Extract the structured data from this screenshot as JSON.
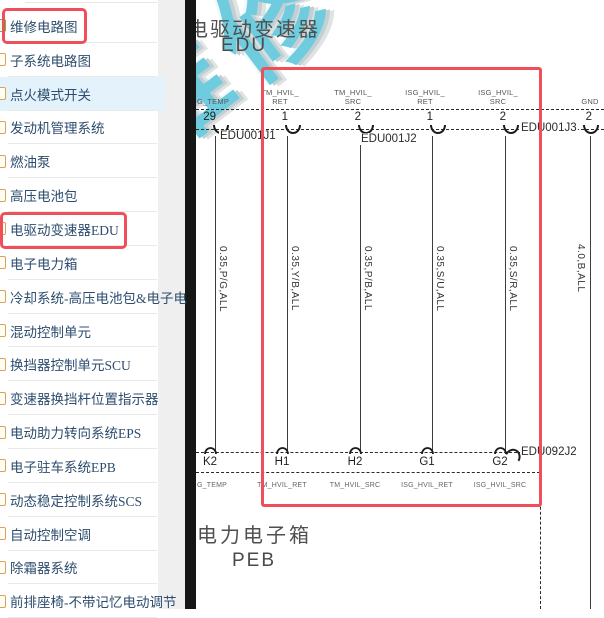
{
  "sidebar": {
    "items": [
      {
        "label": "维修电路图",
        "boxed": true,
        "active": false
      },
      {
        "label": "子系统电路图",
        "boxed": false,
        "active": false
      },
      {
        "label": "点火模式开关",
        "boxed": false,
        "active": true
      },
      {
        "label": "发动机管理系统",
        "boxed": false,
        "active": false
      },
      {
        "label": "燃油泵",
        "boxed": false,
        "active": false
      },
      {
        "label": "高压电池包",
        "boxed": false,
        "active": false
      },
      {
        "label": "电驱动变速器EDU",
        "boxed": true,
        "active": false
      },
      {
        "label": "电子电力箱",
        "boxed": false,
        "active": false
      },
      {
        "label": "冷却系统-高压电池包&电子电",
        "boxed": false,
        "active": false
      },
      {
        "label": "混动控制单元",
        "boxed": false,
        "active": false
      },
      {
        "label": "换挡器控制单元SCU",
        "boxed": false,
        "active": false
      },
      {
        "label": "变速器换挡杆位置指示器",
        "boxed": false,
        "active": false
      },
      {
        "label": "电动助力转向系统EPS",
        "boxed": false,
        "active": false
      },
      {
        "label": "电子驻车系统EPB",
        "boxed": false,
        "active": false
      },
      {
        "label": "动态稳定控制系统SCS",
        "boxed": false,
        "active": false
      },
      {
        "label": "自动控制空调",
        "boxed": false,
        "active": false
      },
      {
        "label": "除霜器系统",
        "boxed": false,
        "active": false
      },
      {
        "label": "前排座椅-不带记忆电动调节",
        "boxed": false,
        "active": false
      }
    ]
  },
  "diagram": {
    "watermark": "维修",
    "top_component": {
      "name": "电驱动变速器",
      "abbr": "EDU"
    },
    "bottom_component": {
      "name": "电力电子箱",
      "abbr": "PEB"
    },
    "top_connectors": {
      "j1": "EDU001J1",
      "j2": "EDU001J2",
      "j3": "EDU001J3"
    },
    "bottom_connector": "EDU092J2",
    "wires": [
      {
        "top_signal_l1": "G_TEMP",
        "top_signal_l2": "",
        "pin": "29",
        "label": "0.35,P/G,ALL",
        "bottom_pin": "K2",
        "bottom_signal": "G_TEMP"
      },
      {
        "top_signal_l1": "TM_HVIL_",
        "top_signal_l2": "RET",
        "pin": "1",
        "label": "0.35,Y/B,ALL",
        "bottom_pin": "H1",
        "bottom_signal": "TM_HVIL_RET"
      },
      {
        "top_signal_l1": "TM_HVIL_",
        "top_signal_l2": "SRC",
        "pin": "2",
        "label": "0.35,P/B,ALL",
        "bottom_pin": "H2",
        "bottom_signal": "TM_HVIL_SRC"
      },
      {
        "top_signal_l1": "ISG_HVIL_",
        "top_signal_l2": "RET",
        "pin": "1",
        "label": "0.35,S/U,ALL",
        "bottom_pin": "G1",
        "bottom_signal": "ISG_HVIL_RET"
      },
      {
        "top_signal_l1": "ISG_HVIL_",
        "top_signal_l2": "SRC",
        "pin": "2",
        "label": "0.35,S/R,ALL",
        "bottom_pin": "G2",
        "bottom_signal": "ISG_HVIL_SRC"
      },
      {
        "top_signal_l1": "GND",
        "top_signal_l2": "",
        "pin": "2",
        "label": "4.0,B,ALL",
        "bottom_pin": "",
        "bottom_signal": ""
      }
    ],
    "colors": {
      "accent_red": "#ef4f58",
      "watermark_cyan": "#5bc6da"
    }
  }
}
